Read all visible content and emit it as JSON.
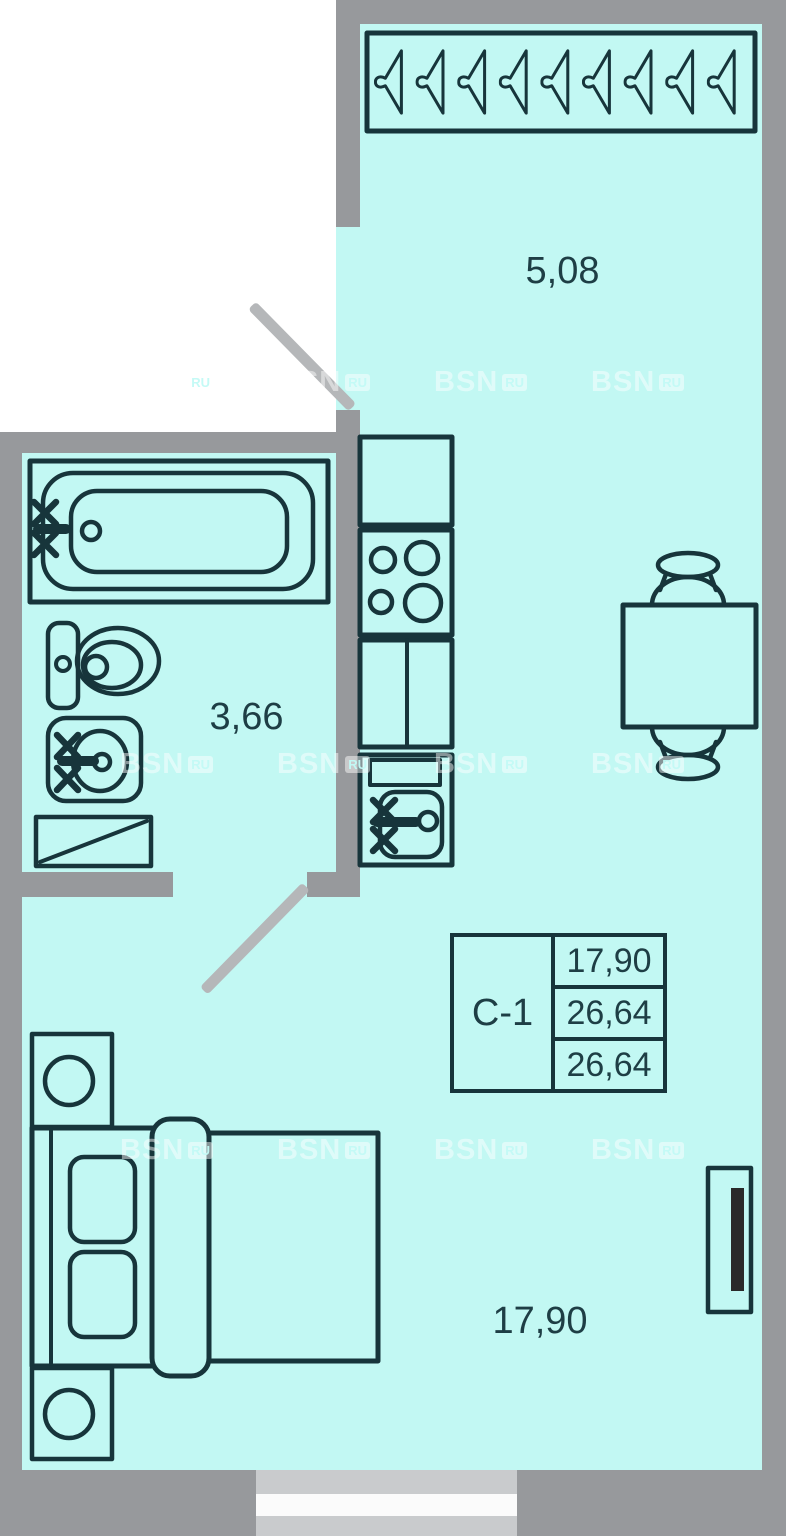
{
  "unit": {
    "label": "С-1",
    "values": [
      "17,90",
      "26,64",
      "26,64"
    ]
  },
  "rooms": {
    "hall": {
      "area": "5,08"
    },
    "bathroom": {
      "area": "3,66"
    },
    "living_room": {
      "area": "17,90"
    }
  },
  "wardrobe": {
    "hanger_count": 9
  },
  "watermark": {
    "text": "BSN",
    "badge": "RU"
  },
  "colors": {
    "room": "#c2f8f3",
    "wall": "#97999c",
    "door": "#b5b7b9",
    "line": "#17353b",
    "text": "#1e3e45",
    "window_frame": "#c9cbcd",
    "window_glass": "#fbfbfb",
    "radiator": "#2a2a2a"
  }
}
